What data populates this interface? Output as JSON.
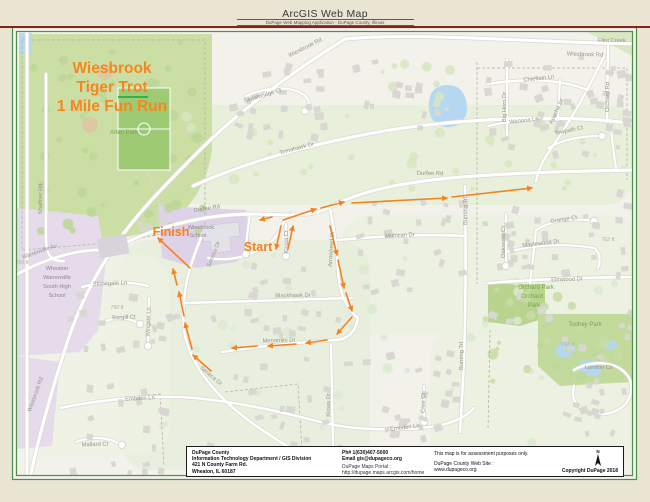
{
  "header": {
    "title": "ArcGIS Web Map",
    "subtitle": "DuPage Web Mapping Application - DuPage County, Illinois"
  },
  "event_title": {
    "line1": "Wiesbrook",
    "line2a": "Tiger ",
    "line2b": "Trot",
    "line3": "1 Mile Fun Run",
    "color": "#f6871f"
  },
  "map": {
    "route": {
      "color": "#f58220",
      "segments": [
        [
          190,
          268,
          158,
          238
        ],
        [
          281,
          226,
          276,
          249
        ],
        [
          288,
          249,
          293,
          226
        ],
        [
          283,
          220,
          316,
          209
        ],
        [
          321,
          208,
          344,
          202
        ],
        [
          352,
          203,
          447,
          198
        ],
        [
          452,
          197,
          532,
          188
        ],
        [
          330,
          226,
          337,
          255
        ],
        [
          338,
          260,
          344,
          288
        ],
        [
          346,
          293,
          352,
          311
        ],
        [
          352,
          317,
          337,
          334
        ],
        [
          327,
          340,
          306,
          343
        ],
        [
          296,
          344,
          268,
          346
        ],
        [
          257,
          346,
          232,
          348
        ],
        [
          211,
          371,
          193,
          355
        ],
        [
          192,
          349,
          185,
          323
        ],
        [
          184,
          316,
          179,
          292
        ],
        [
          177,
          285,
          173,
          269
        ],
        [
          272,
          217,
          260,
          220
        ]
      ]
    },
    "labels": [
      {
        "t": "Flint Creek",
        "x": 612,
        "y": 42,
        "r": 0,
        "c": "st"
      },
      {
        "t": "Wiesbrook Rd",
        "x": 306,
        "y": 49,
        "r": -27,
        "c": "st"
      },
      {
        "t": "Wiesbrook Rd",
        "x": 585,
        "y": 56,
        "r": 2,
        "c": "st"
      },
      {
        "t": "Stonebridge Ct",
        "x": 263,
        "y": 97,
        "r": -17,
        "c": "st"
      },
      {
        "t": "Chieftain Ln",
        "x": 539,
        "y": 80,
        "r": -6,
        "c": "st"
      },
      {
        "t": "Big Horn Dr",
        "x": 506,
        "y": 107,
        "r": -90,
        "c": "st"
      },
      {
        "t": "Orchard Rd",
        "x": 609,
        "y": 97,
        "r": -90,
        "c": "st"
      },
      {
        "t": "Apache Dr",
        "x": 558,
        "y": 112,
        "r": -65,
        "c": "st"
      },
      {
        "t": "Wenona Ln",
        "x": 524,
        "y": 122,
        "r": -7,
        "c": "st"
      },
      {
        "t": "Towpath Ct",
        "x": 569,
        "y": 132,
        "r": -12,
        "c": "st"
      },
      {
        "t": "Atten Park",
        "x": 124,
        "y": 134,
        "r": 0,
        "c": "park"
      },
      {
        "t": "Tomahawk Dr",
        "x": 297,
        "y": 150,
        "r": -15,
        "c": "st"
      },
      {
        "t": "Durfee Rd",
        "x": 430,
        "y": 175,
        "r": 1,
        "c": "st"
      },
      {
        "t": "Durfee Rd",
        "x": 207,
        "y": 210,
        "r": -9,
        "c": "st"
      },
      {
        "t": "Shaffner Rd",
        "x": 42,
        "y": 199,
        "r": -90,
        "c": "st"
      },
      {
        "t": "Grange Ct",
        "x": 564,
        "y": 221,
        "r": -9,
        "c": "st"
      },
      {
        "t": "Oakwood Ct",
        "x": 505,
        "y": 242,
        "r": -90,
        "c": "st"
      },
      {
        "t": "Maplewood Dr",
        "x": 541,
        "y": 245,
        "r": -7,
        "c": "st"
      },
      {
        "t": "762 ft",
        "x": 608,
        "y": 241,
        "r": 0,
        "c": "elev"
      },
      {
        "t": "Mohican Dr",
        "x": 400,
        "y": 237,
        "r": -3,
        "c": "st"
      },
      {
        "t": "Burning Trl",
        "x": 467,
        "y": 211,
        "r": -90,
        "c": "st"
      },
      {
        "t": "Burning Trl",
        "x": 463,
        "y": 356,
        "r": -90,
        "c": "st"
      },
      {
        "t": "Wiesbrook",
        "x": 201,
        "y": 229,
        "r": 0,
        "c": "sch"
      },
      {
        "t": "School",
        "x": 198,
        "y": 237,
        "r": 0,
        "c": "sch"
      },
      {
        "t": "Seneca Dr",
        "x": 215,
        "y": 255,
        "r": -68,
        "c": "st"
      },
      {
        "t": "Kiowa Ct",
        "x": 288,
        "y": 242,
        "r": -90,
        "c": "st"
      },
      {
        "t": "Arrowhead Dr",
        "x": 333,
        "y": 249,
        "r": -86,
        "c": "st"
      },
      {
        "t": "Warrenville Av",
        "x": 40,
        "y": 253,
        "r": -19,
        "c": "st"
      },
      {
        "t": "650 ft",
        "x": 22,
        "y": 264,
        "r": 0,
        "c": "elev"
      },
      {
        "t": "Wheaton",
        "x": 57,
        "y": 270,
        "r": 0,
        "c": "sch"
      },
      {
        "t": "Warrenville",
        "x": 57,
        "y": 279,
        "r": 0,
        "c": "sch"
      },
      {
        "t": "South High",
        "x": 57,
        "y": 288,
        "r": 0,
        "c": "sch"
      },
      {
        "t": "School",
        "x": 57,
        "y": 297,
        "r": 0,
        "c": "sch"
      },
      {
        "t": "Stonegate Ln",
        "x": 110,
        "y": 285,
        "r": -2,
        "c": "st"
      },
      {
        "t": "790 ft",
        "x": 117,
        "y": 309,
        "r": 0,
        "c": "elev"
      },
      {
        "t": "Bargill Ct",
        "x": 124,
        "y": 319,
        "r": -2,
        "c": "st"
      },
      {
        "t": "Wingate Ln",
        "x": 150,
        "y": 322,
        "r": -87,
        "c": "st"
      },
      {
        "t": "Elmwood Dr",
        "x": 567,
        "y": 281,
        "r": -2,
        "c": "st"
      },
      {
        "t": "Orchard Park",
        "x": 536,
        "y": 289,
        "r": 0,
        "c": "park"
      },
      {
        "t": "Orchard",
        "x": 532,
        "y": 298,
        "r": 0,
        "c": "park"
      },
      {
        "t": "Park",
        "x": 534,
        "y": 307,
        "r": 0,
        "c": "park"
      },
      {
        "t": "Blackhawk Dr",
        "x": 293,
        "y": 297,
        "r": -1,
        "c": "st"
      },
      {
        "t": "Toohey Park",
        "x": 585,
        "y": 326,
        "r": 0,
        "c": "park"
      },
      {
        "t": "750 ft",
        "x": 568,
        "y": 346,
        "r": 0,
        "c": "elev"
      },
      {
        "t": "Landon Cir",
        "x": 599,
        "y": 369,
        "r": 0,
        "c": "st"
      },
      {
        "t": "Menomini Dr",
        "x": 279,
        "y": 342,
        "r": -2,
        "c": "st"
      },
      {
        "t": "Seneca Dr",
        "x": 210,
        "y": 377,
        "r": 40,
        "c": "st"
      },
      {
        "t": "Kiowa Dr",
        "x": 330,
        "y": 405,
        "r": -90,
        "c": "st"
      },
      {
        "t": "Cree Ct",
        "x": 425,
        "y": 403,
        "r": -88,
        "c": "st"
      },
      {
        "t": "Embden Ln",
        "x": 140,
        "y": 400,
        "r": -3,
        "c": "st"
      },
      {
        "t": "Embden Ln",
        "x": 405,
        "y": 429,
        "r": -7,
        "c": "st"
      },
      {
        "t": "Mallard Ct",
        "x": 95,
        "y": 446,
        "r": -2,
        "c": "st"
      },
      {
        "t": "Wiesbrook Rd",
        "x": 37,
        "y": 395,
        "r": -70,
        "c": "st"
      },
      {
        "t": "Finish",
        "x": 171,
        "y": 236,
        "r": 0,
        "c": "omd"
      },
      {
        "t": "Start",
        "x": 258,
        "y": 251,
        "r": 0,
        "c": "omd"
      }
    ]
  },
  "footer": {
    "agency": [
      "DuPage County",
      "Information Technology Department / GIS Division",
      "421 N County Farm Rd.",
      "Wheaton, IL 60187"
    ],
    "contact": {
      "phone": "Ph# 1(630)407-5000",
      "email": "Email gis@dupageco.org",
      "portal_label": "DuPage Maps Portal :",
      "portal_url": "http://dupage.maps.arcgis.com/home"
    },
    "notes": [
      "This map is for assessment purposes only.",
      "DuPage County Web Site :",
      "www.dupageco.org"
    ],
    "north_label": "N",
    "copyright": "Copyright DuPage 2018"
  }
}
